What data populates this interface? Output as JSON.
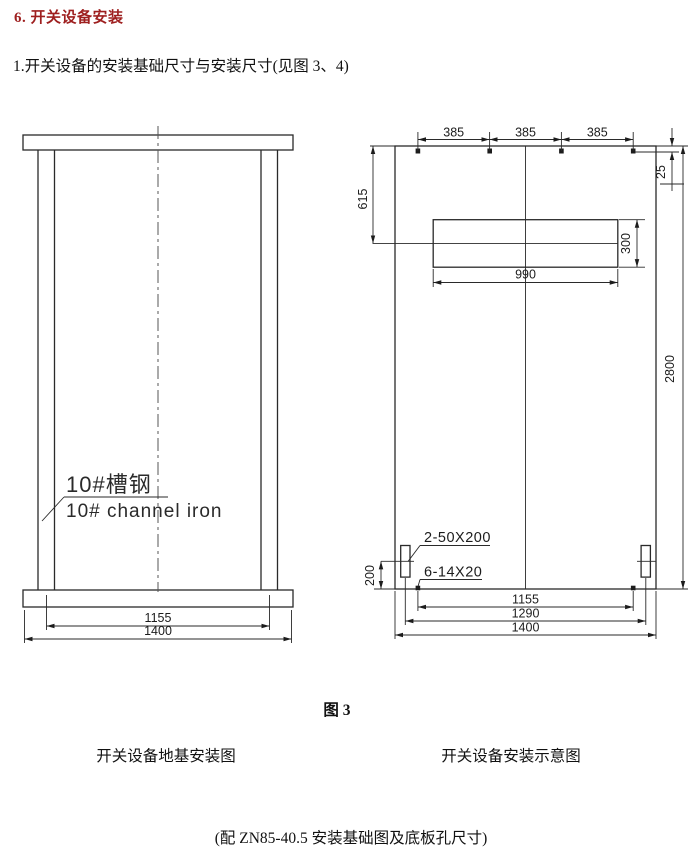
{
  "document": {
    "section_title": "6. 开关设备安装",
    "section_title_color": "#9e1f1f",
    "intro": "1.开关设备的安装基础尺寸与安装尺寸(见图 3、4)",
    "figure_label": "图 3",
    "captions": {
      "left": "开关设备地基安装图",
      "right": "开关设备安装示意图"
    },
    "footnote": "(配 ZN85-40.5  安装基础图及底板孔尺寸)"
  },
  "foundation_drawing": {
    "labels": {
      "channel_cn": "10#槽钢",
      "channel_en": "10# channel iron"
    },
    "dims": {
      "inner_span": "1155",
      "outer_span": "1400"
    }
  },
  "installation_drawing": {
    "dims": {
      "bolt_spacings": [
        "385",
        "385",
        "385"
      ],
      "top_to_opening": "615",
      "edge_to_bolt": "25",
      "opening_width": "990",
      "opening_height": "300",
      "overall_height": "2800",
      "slot_to_edge": "200",
      "slot_spec": "2-50X200",
      "holes_spec": "6-14X20",
      "bolt_span": "1155",
      "slot_span": "1290",
      "overall_width": "1400"
    }
  }
}
